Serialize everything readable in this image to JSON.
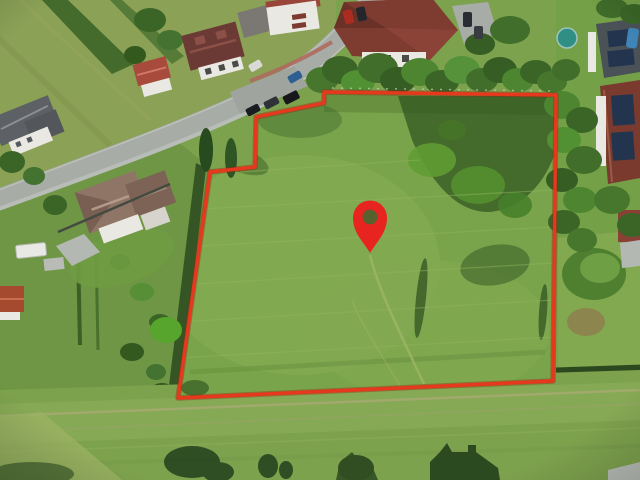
{
  "scene": {
    "type": "aerial-drone-photo",
    "subject": "Aerial view of a grassy building plot outlined in red with a red location pin, suburban street with houses, gardens, trees and fields around it"
  },
  "boundary": {
    "color": "#e5381d",
    "shadow_color": "#992313",
    "stroke_width": "3.4",
    "points": "324,92 556,95 553,381 178,398 210,172 255,167 256,117 324,103"
  },
  "pin": {
    "color": "#e82420",
    "hole_color": "#56622e",
    "path": "M370,253 C363.5,241.5 353,233.5 353,217.5 A17,17 0 1 1 387,217.5 C387,233.5 376.5,241.5 370,253 Z",
    "hole_cx": "370",
    "hole_cy": "217",
    "hole_r": "7.4"
  },
  "photo": {
    "road_color": "#a8aca7",
    "grass_parcel": "#7aa44b",
    "grass_field": "#8aa156",
    "grass_bottom": "#7da24d",
    "tree_dark": "#3a6527",
    "tree_light": "#55923a",
    "roof_red": "#7e3b30",
    "roof_gray": "#5d6064",
    "solar_panel": "#22344e",
    "wall_white": "#eae8e2"
  }
}
